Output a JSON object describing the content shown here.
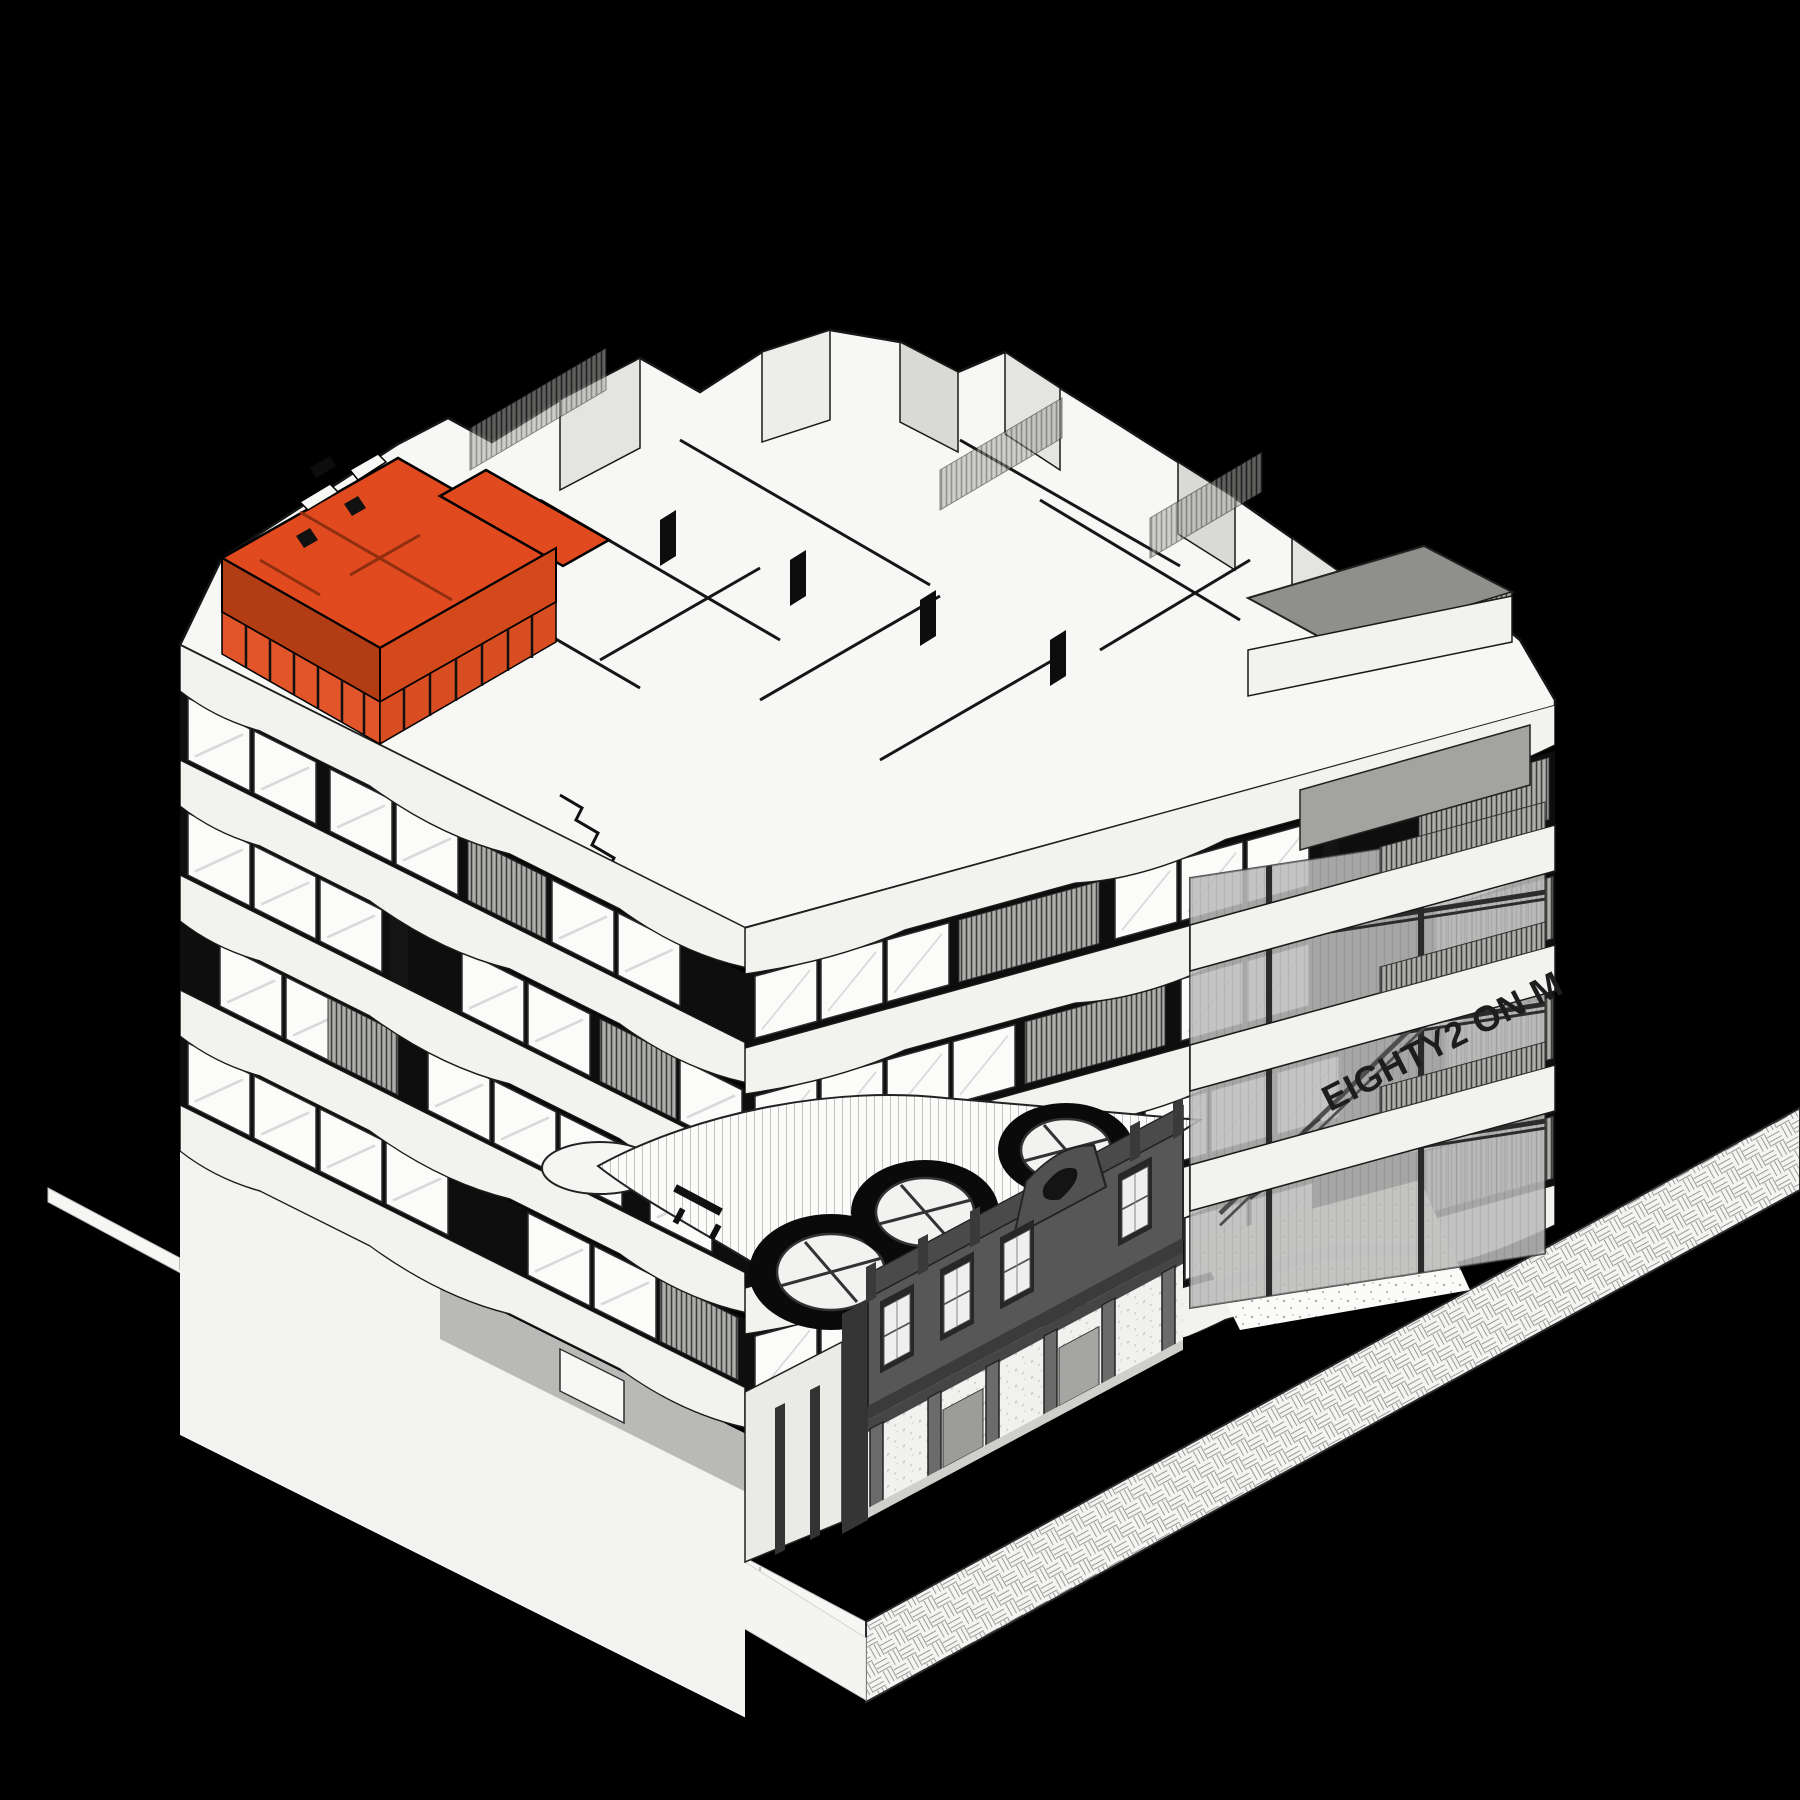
{
  "signage": {
    "text": "EIGHTY2 ON M"
  },
  "highlighted_unit": {
    "status": "selected"
  },
  "palette": {
    "background": "#000000",
    "building_white": "#F7F7F5",
    "slab": "#F2F2EF",
    "window_dark": "#0E0E0E",
    "heritage_gray": "#575757",
    "atrium_glass": "#9B9B9B",
    "signage_color": "#1D1D1D",
    "highlight": "#E14A1E",
    "highlight_shade": "#B23C14",
    "highlight_face": "#D4491C"
  }
}
